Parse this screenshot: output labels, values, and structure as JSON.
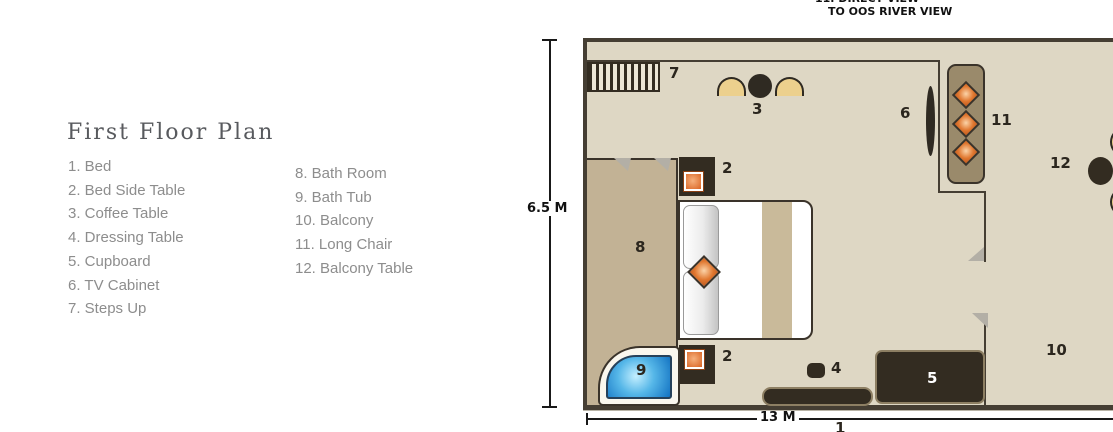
{
  "legend": {
    "title": "First Floor Plan",
    "column1": [
      "1. Bed",
      "2. Bed Side Table",
      "3. Coffee Table",
      "4. Dressing Table",
      "5. Cupboard",
      "6. TV Cabinet",
      "7. Steps Up"
    ],
    "column2": [
      "8. Bath Room",
      "9. Bath Tub",
      "10. Balcony",
      "11. Long Chair",
      "12. Balcony Table"
    ]
  },
  "plan": {
    "note": {
      "line1": "11. DIRECT VIEW",
      "line2": "TO OOS RIVER VIEW"
    },
    "dimensions": {
      "height": "6.5 M",
      "width": "13 M"
    },
    "markers": {
      "bed": "1",
      "bed_side_table_top": "2",
      "bed_side_table_bottom": "2",
      "coffee_table": "3",
      "dressing_table": "4",
      "cupboard": "5",
      "tv_cabinet": "6",
      "steps_up": "7",
      "bath_room": "8",
      "bath_tub": "9",
      "balcony": "10",
      "long_chair": "11",
      "balcony_table": "12"
    }
  },
  "colors": {
    "floor": "#ded7c4",
    "bathroom_floor": "#c2b295",
    "wall": "#453e33",
    "dark_furniture": "#332c21",
    "chair_yellow": "#ecd08d",
    "cushion_orange": "#e0772f",
    "long_chair_brown": "#9a8a6b",
    "bathtub_blue": "#1272c2"
  }
}
